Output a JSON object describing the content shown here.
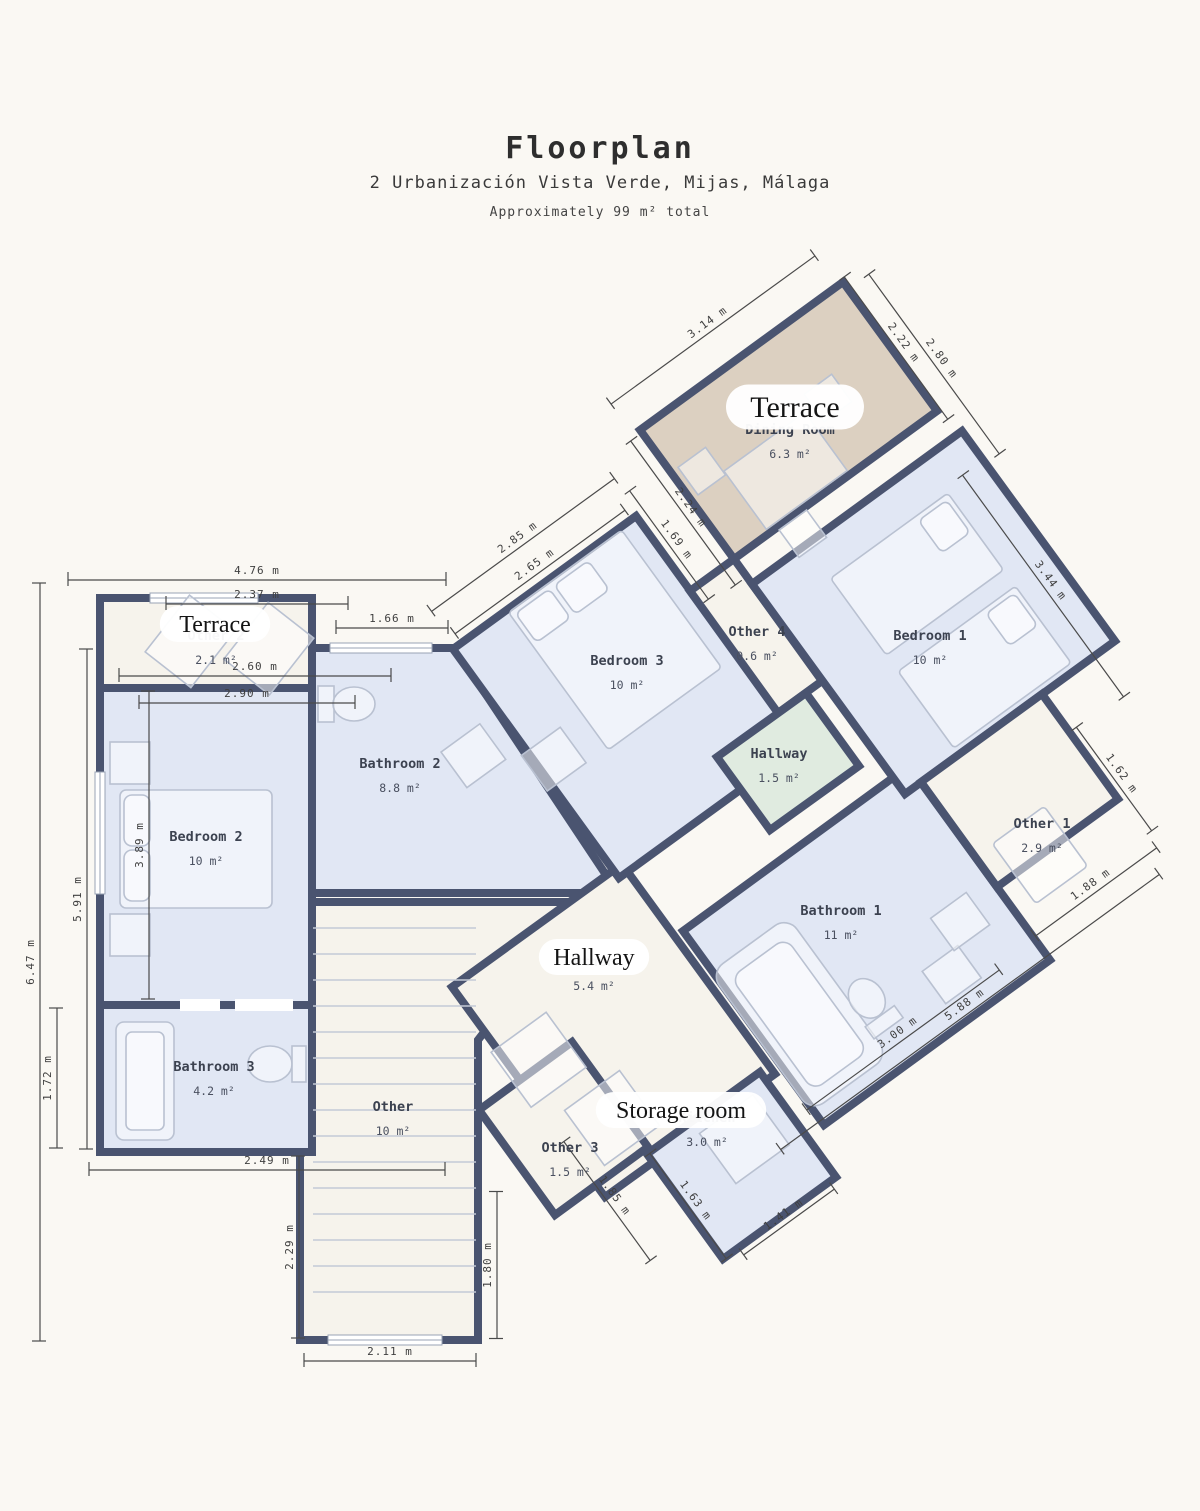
{
  "header": {
    "title": "Floorplan",
    "address": "2 Urbanización Vista Verde, Mijas, Málaga",
    "subtitle": "Approximately 99 m² total"
  },
  "colors": {
    "wall": "#4a5470",
    "room_blue": "#e1e7f4",
    "room_cream": "#f6f3ec",
    "room_tan": "#dcd0c1",
    "room_green": "#e0ebe0",
    "background": "#faf8f3",
    "dimension_text": "#3f3f3f"
  },
  "rooms": [
    {
      "name": "Dining Room",
      "area": "6.3 m²",
      "x": 790,
      "y": 434
    },
    {
      "name": "Bedroom 1",
      "area": "10 m²",
      "x": 930,
      "y": 640
    },
    {
      "name": "Bedroom 3",
      "area": "10 m²",
      "x": 627,
      "y": 665
    },
    {
      "name": "Other 4",
      "area": "0.6 m²",
      "x": 757,
      "y": 636
    },
    {
      "name": "Hallway",
      "area": "1.5 m²",
      "x": 779,
      "y": 758
    },
    {
      "name": "Other 1",
      "area": "2.9 m²",
      "x": 1042,
      "y": 828
    },
    {
      "name": "Bathroom 1",
      "area": "11 m²",
      "x": 841,
      "y": 915
    },
    {
      "name": "Bathroom 2",
      "area": "8.8 m²",
      "x": 400,
      "y": 768
    },
    {
      "name": "Bedroom 2",
      "area": "10 m²",
      "x": 206,
      "y": 841
    },
    {
      "name": "Bathroom 3",
      "area": "4.2 m²",
      "x": 214,
      "y": 1071
    },
    {
      "name": "Other",
      "area": "10 m²",
      "x": 393,
      "y": 1111
    },
    {
      "name": "Other",
      "area": "5.4 m²",
      "x": 594,
      "y": 966
    },
    {
      "name": "Kitchen",
      "area": "3.0 m²",
      "x": 707,
      "y": 1122
    },
    {
      "name": "Other 3",
      "area": "1.5 m²",
      "x": 570,
      "y": 1152
    },
    {
      "name": "Other 2",
      "area": "2.1 m²",
      "x": 216,
      "y": 640
    }
  ],
  "pills": [
    {
      "text": "Terrace",
      "x": 795,
      "y": 407,
      "size": 30
    },
    {
      "text": "Terrace",
      "x": 215,
      "y": 624,
      "size": 24
    },
    {
      "text": "Hallway",
      "x": 594,
      "y": 957,
      "size": 24
    },
    {
      "text": "Storage room",
      "x": 681,
      "y": 1110,
      "size": 24
    }
  ],
  "dimensions": [
    {
      "label": "4.76 m",
      "x": 257,
      "y": 580,
      "rot": 0,
      "len": 378
    },
    {
      "label": "2.37 m",
      "x": 257,
      "y": 604,
      "rot": 0,
      "len": 182
    },
    {
      "label": "1.66 m",
      "x": 392,
      "y": 628,
      "rot": 0,
      "len": 112
    },
    {
      "label": "2.60 m",
      "x": 255,
      "y": 676,
      "rot": 0,
      "len": 272
    },
    {
      "label": "2.90 m",
      "x": 247,
      "y": 703,
      "rot": 0,
      "len": 216
    },
    {
      "label": "6.47 m",
      "x": 40,
      "y": 962,
      "rot": -90,
      "len": 758
    },
    {
      "label": "5.91 m",
      "x": 87,
      "y": 899,
      "rot": -90,
      "len": 500
    },
    {
      "label": "3.89 m",
      "x": 149,
      "y": 845,
      "rot": -90,
      "len": 308
    },
    {
      "label": "1.72 m",
      "x": 57,
      "y": 1078,
      "rot": -90,
      "len": 140
    },
    {
      "label": "2.49 m",
      "x": 267,
      "y": 1170,
      "rot": 0,
      "len": 356
    },
    {
      "label": "2.29 m",
      "x": 299,
      "y": 1247,
      "rot": -90,
      "len": 182
    },
    {
      "label": "2.11 m",
      "x": 390,
      "y": 1361,
      "rot": 0,
      "len": 172
    },
    {
      "label": "1.80 m",
      "x": 497,
      "y": 1265,
      "rot": -90,
      "len": 147
    },
    {
      "label": "3.14 m",
      "x": 713,
      "y": 330,
      "rot": -36,
      "len": 252
    },
    {
      "label": "2.22 m",
      "x": 896,
      "y": 348,
      "rot": 54,
      "len": 176
    },
    {
      "label": "2.80 m",
      "x": 934,
      "y": 364,
      "rot": 54,
      "len": 222
    },
    {
      "label": "2.24 m",
      "x": 683,
      "y": 513,
      "rot": 54,
      "len": 178
    },
    {
      "label": "1.69 m",
      "x": 669,
      "y": 545,
      "rot": 54,
      "len": 134
    },
    {
      "label": "2.85 m",
      "x": 523,
      "y": 545,
      "rot": -36,
      "len": 226
    },
    {
      "label": "2.65 m",
      "x": 540,
      "y": 572,
      "rot": -36,
      "len": 210
    },
    {
      "label": "3.44 m",
      "x": 1043,
      "y": 586,
      "rot": 54,
      "len": 274
    },
    {
      "label": "1.62 m",
      "x": 1114,
      "y": 779,
      "rot": 54,
      "len": 128
    },
    {
      "label": "1.88 m",
      "x": 1096,
      "y": 892,
      "rot": -36,
      "len": 150
    },
    {
      "label": "5.88 m",
      "x": 970,
      "y": 1012,
      "rot": -36,
      "len": 468
    },
    {
      "label": "3.00 m",
      "x": 903,
      "y": 1040,
      "rot": -36,
      "len": 238
    },
    {
      "label": "1.41 m",
      "x": 789,
      "y": 1222,
      "rot": -36,
      "len": 112
    },
    {
      "label": "1.63 m",
      "x": 688,
      "y": 1206,
      "rot": 54,
      "len": 130
    },
    {
      "label": "1.85 m",
      "x": 607,
      "y": 1201,
      "rot": 54,
      "len": 147
    }
  ]
}
